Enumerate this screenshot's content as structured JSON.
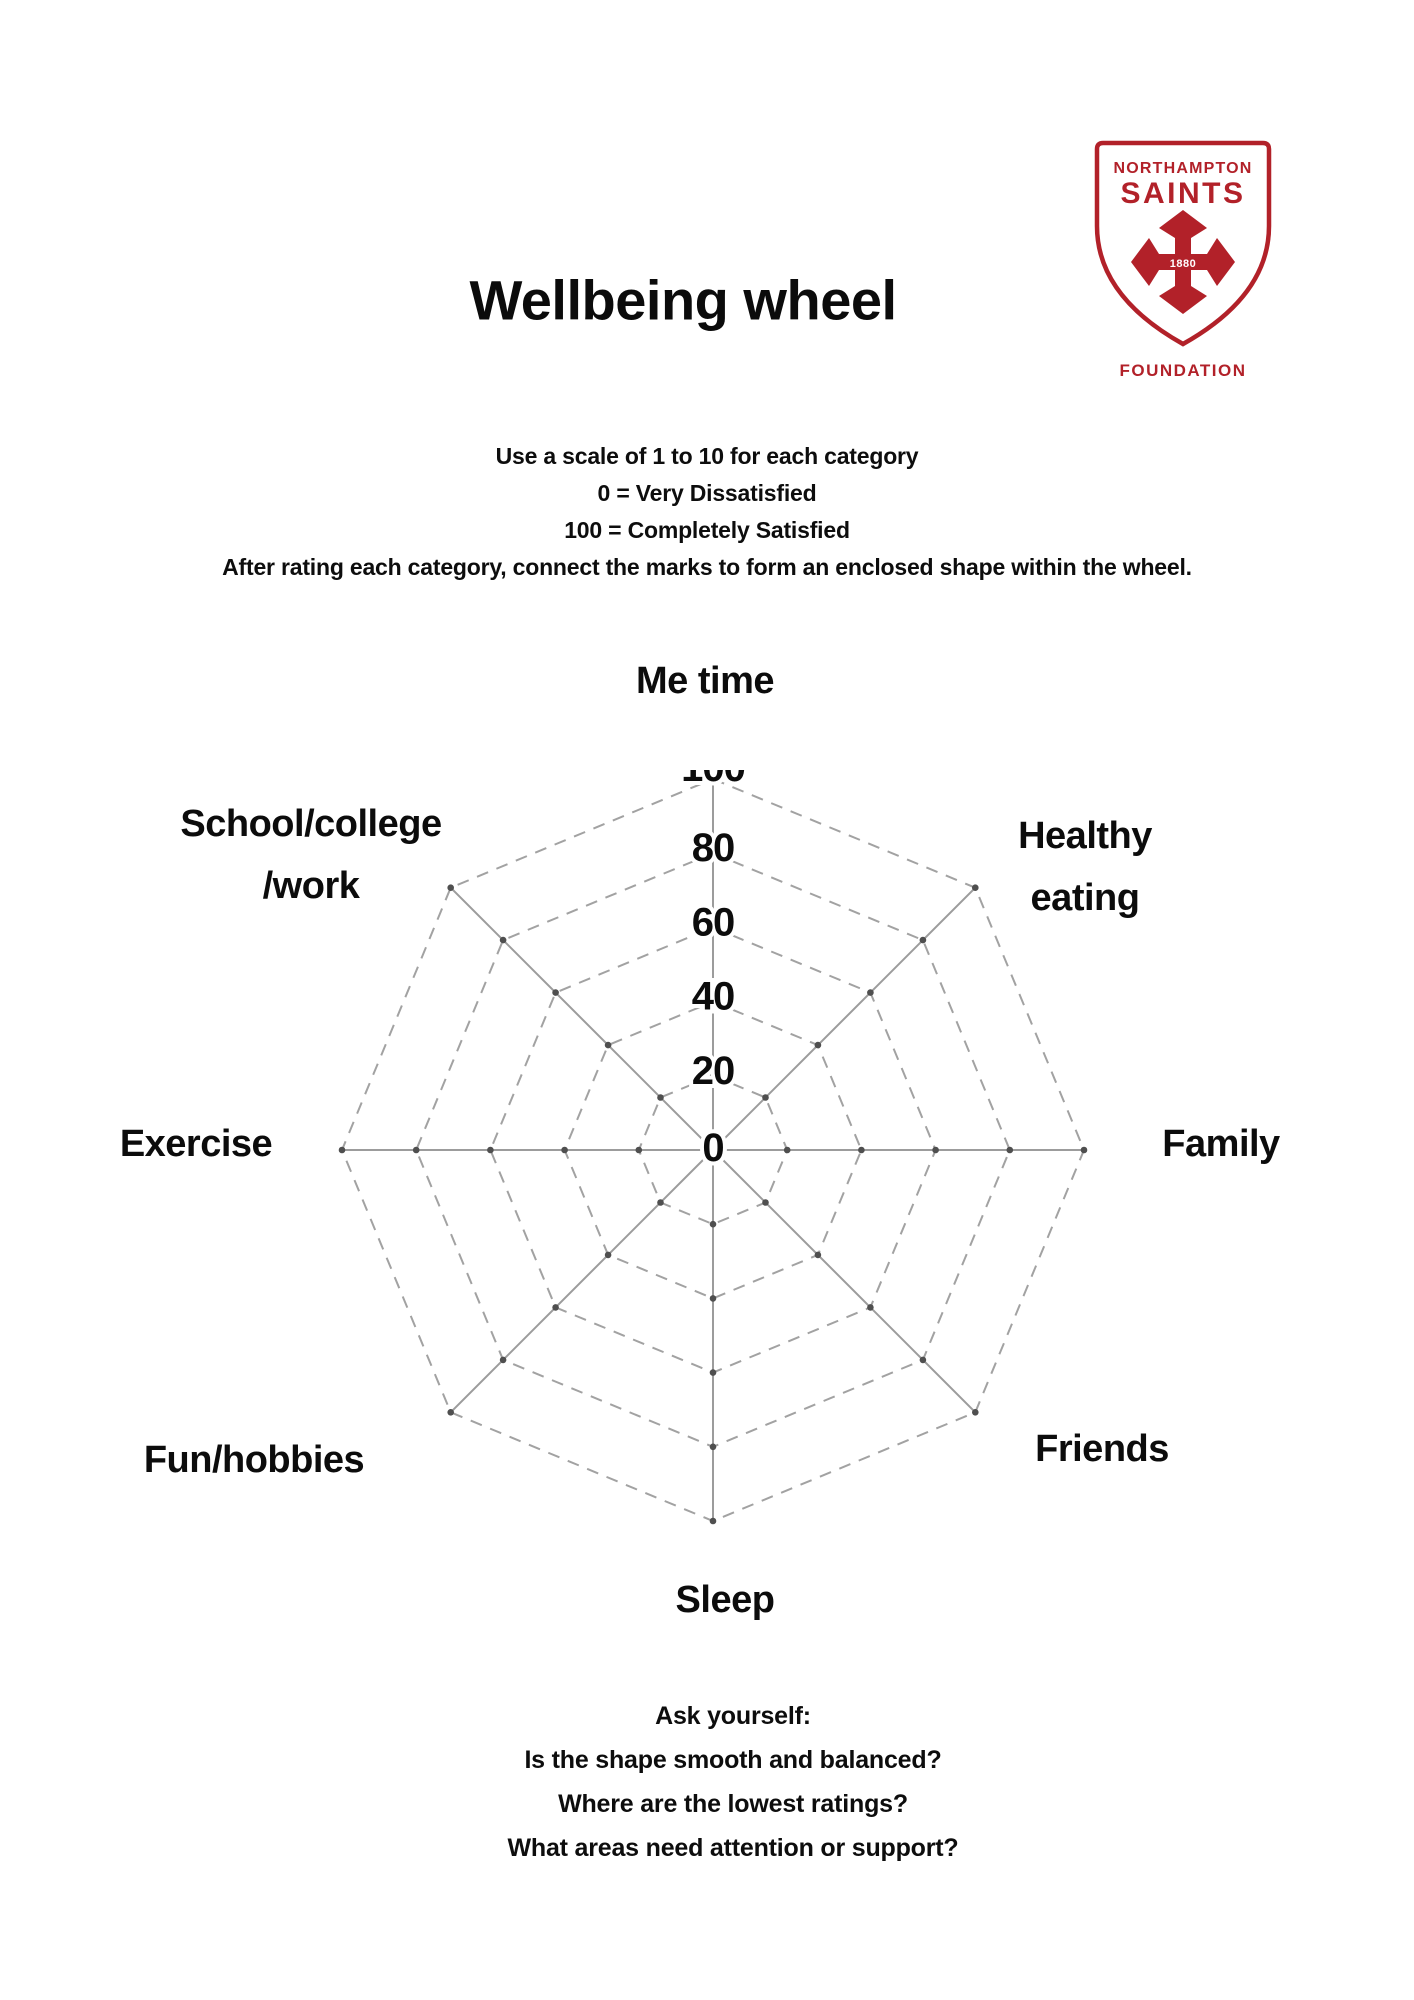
{
  "page": {
    "title": "Wellbeing wheel"
  },
  "logo": {
    "org": "NORTHAMPTON",
    "brand": "SAINTS",
    "year": "1880",
    "foundation": "FOUNDATION",
    "red": "#b22129"
  },
  "instructions": {
    "lines": [
      "Use a scale of 1 to 10 for each category",
      "0 = Very Dissatisfied",
      "100 = Completely Satisfied",
      "After rating each category, connect the marks to form an enclosed shape within the wheel."
    ]
  },
  "chart_data": {
    "type": "radar",
    "title": "Wellbeing wheel",
    "categories": [
      "Me time",
      "Healthy eating",
      "Family",
      "Friends",
      "Sleep",
      "Fun/hobbies",
      "Exercise",
      "School/college /work"
    ],
    "axis_ticks": [
      0,
      20,
      40,
      60,
      80,
      100
    ],
    "max": 100,
    "rings": 5,
    "series": [],
    "grid_on": true,
    "grid_color": "#9c9c9c",
    "ring_color": "#a2a2a2",
    "dot_color": "#4f4f4f",
    "tick_color": "#0c0c0c"
  },
  "questions": {
    "heading": "Ask yourself:",
    "lines": [
      "Is the shape smooth and balanced?",
      "Where are the lowest ratings?",
      "What areas need attention or support?"
    ]
  }
}
